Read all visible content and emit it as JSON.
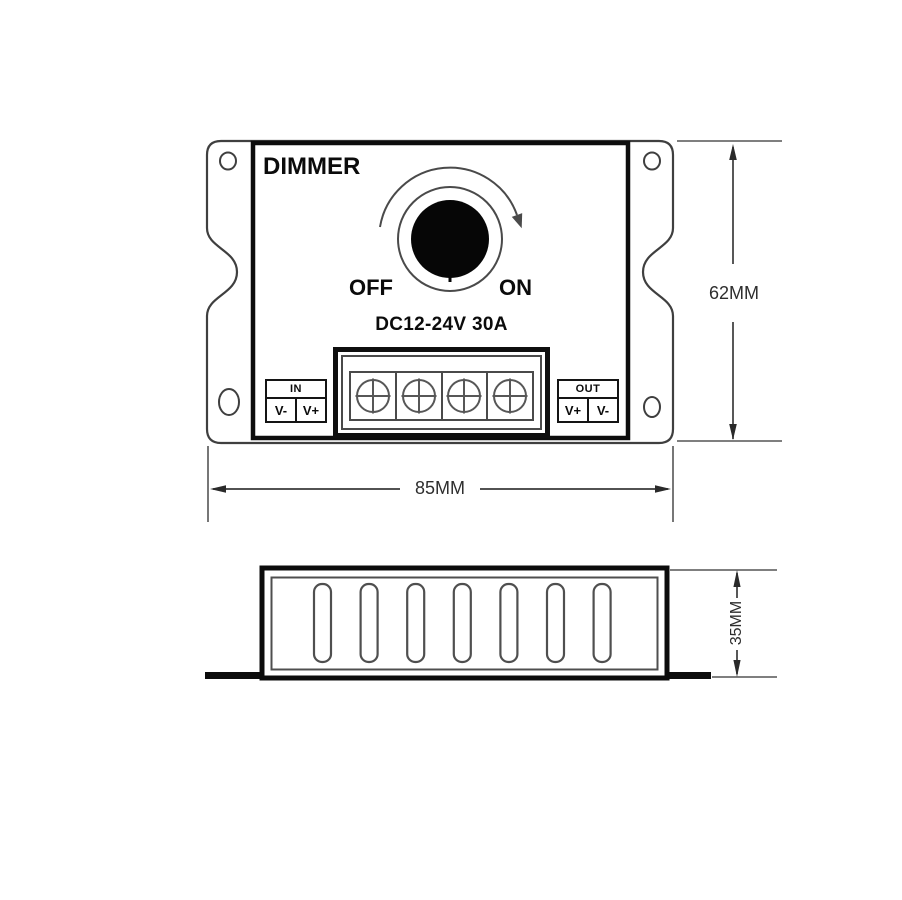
{
  "drawing_title": "DIMMER",
  "colors": {
    "line": "#3f3f3f",
    "heavy_line": "#0d0d0d",
    "mid_gray": "#4f4f4f",
    "dimension": "#2e2e2e",
    "background": "#ffffff",
    "knob_fill": "#060606"
  },
  "top_view": {
    "name_label": "DIMMER",
    "off_label": "OFF",
    "on_label": "ON",
    "rating_label": "DC12-24V 30A",
    "terminal_screw_count": 4,
    "in_block": {
      "title": "IN",
      "left": "V-",
      "right": "V+"
    },
    "out_block": {
      "title": "OUT",
      "left": "V+",
      "right": "V-"
    },
    "width_dimension": "85MM",
    "height_dimension": "62MM"
  },
  "side_view": {
    "vent_slot_count": 7,
    "height_dimension": "35MM"
  }
}
